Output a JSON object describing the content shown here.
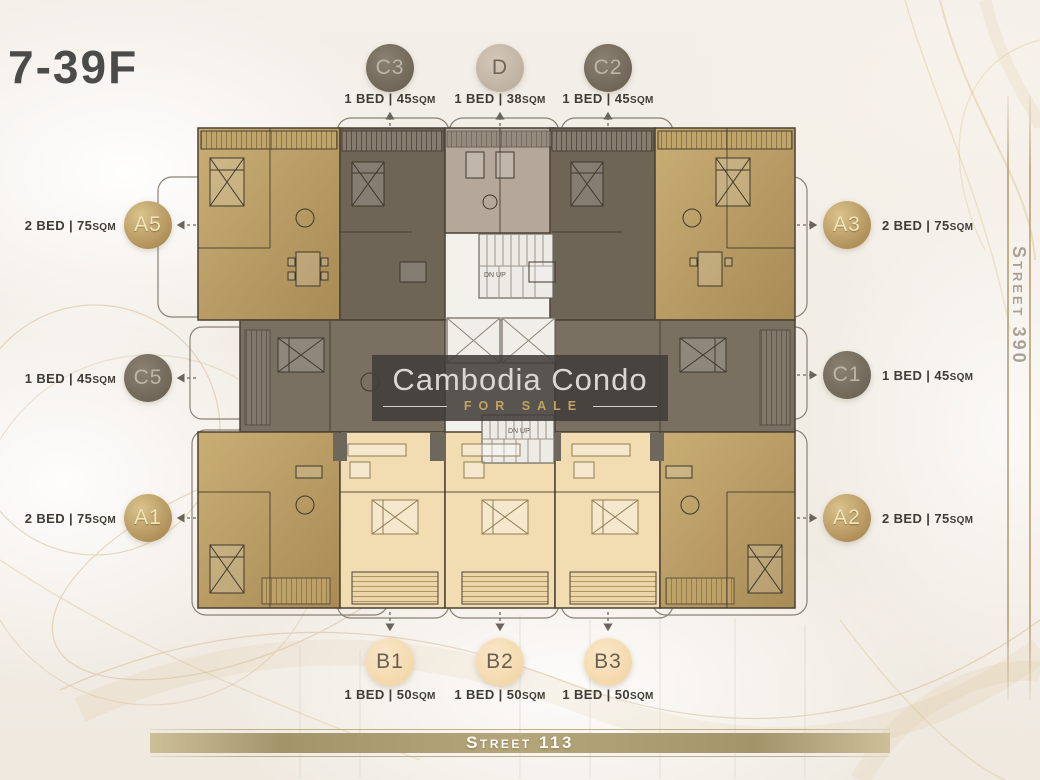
{
  "title": "7-39F",
  "watermark": {
    "name": "Cambodia Condo",
    "tagline": "FOR SALE"
  },
  "streets": {
    "bottom": "Street 113",
    "right": "Street 390"
  },
  "core": {
    "stair_top_label": "DN UP",
    "stair_bottom_label": "DN UP"
  },
  "sqm_unit": "SQM",
  "units": [
    {
      "id": "C3",
      "name": "C3",
      "spec": "1 BED | 45",
      "suffix": "SQM",
      "beds": 1,
      "area_sqm": 45,
      "style": "gray",
      "position": "top"
    },
    {
      "id": "D",
      "name": "D",
      "spec": "1 BED | 38",
      "suffix": "SQM",
      "beds": 1,
      "area_sqm": 38,
      "style": "beige",
      "position": "top"
    },
    {
      "id": "C2",
      "name": "C2",
      "spec": "1 BED | 45",
      "suffix": "SQM",
      "beds": 1,
      "area_sqm": 45,
      "style": "gray",
      "position": "top"
    },
    {
      "id": "A5",
      "name": "A5",
      "spec": "2 BED | 75",
      "suffix": "SQM",
      "beds": 2,
      "area_sqm": 75,
      "style": "gold",
      "position": "left"
    },
    {
      "id": "A3",
      "name": "A3",
      "spec": "2 BED | 75",
      "suffix": "SQM",
      "beds": 2,
      "area_sqm": 75,
      "style": "gold",
      "position": "right"
    },
    {
      "id": "C5",
      "name": "C5",
      "spec": "1 BED | 45",
      "suffix": "SQM",
      "beds": 1,
      "area_sqm": 45,
      "style": "gray",
      "position": "left"
    },
    {
      "id": "C1",
      "name": "C1",
      "spec": "1 BED | 45",
      "suffix": "SQM",
      "beds": 1,
      "area_sqm": 45,
      "style": "gray",
      "position": "right"
    },
    {
      "id": "A1",
      "name": "A1",
      "spec": "2 BED | 75",
      "suffix": "SQM",
      "beds": 2,
      "area_sqm": 75,
      "style": "gold",
      "position": "left"
    },
    {
      "id": "A2",
      "name": "A2",
      "spec": "2 BED | 75",
      "suffix": "SQM",
      "beds": 2,
      "area_sqm": 75,
      "style": "gold",
      "position": "right"
    },
    {
      "id": "B1",
      "name": "B1",
      "spec": "1 BED | 50",
      "suffix": "SQM",
      "beds": 1,
      "area_sqm": 50,
      "style": "peach",
      "position": "bottom"
    },
    {
      "id": "B2",
      "name": "B2",
      "spec": "1 BED | 50",
      "suffix": "SQM",
      "beds": 1,
      "area_sqm": 50,
      "style": "peach",
      "position": "bottom"
    },
    {
      "id": "B3",
      "name": "B3",
      "spec": "1 BED | 50",
      "suffix": "SQM",
      "beds": 1,
      "area_sqm": 50,
      "style": "peach",
      "position": "bottom"
    }
  ],
  "colors": {
    "gold_unit": "#b99a5f",
    "gray_unit": "#6f6557",
    "taupe_unit": "#b4a89a",
    "cream_unit": "#f2dcb2",
    "badge_gray": "#7b7164",
    "badge_beige": "#c8bbaa",
    "badge_peach": "#f8dfb8",
    "accent_gold": "#c3b088",
    "street_bar": "#ab9d70",
    "watermark_bg": "#403d38",
    "for_sale_gold": "#c2a35f",
    "background": "#f1ece4"
  }
}
